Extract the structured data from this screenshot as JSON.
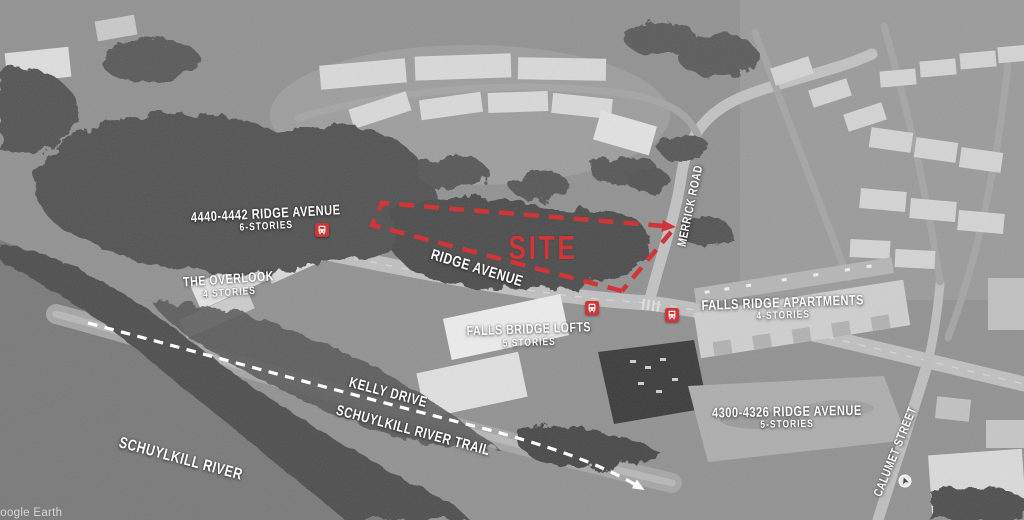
{
  "map": {
    "watermark": "Google Earth",
    "site": {
      "label": "SITE"
    },
    "streets": {
      "ridge_avenue": "RIDGE AVENUE",
      "merrick_road": "MERRICK ROAD",
      "kelly_drive": "KELLY DRIVE",
      "schuylkill_river_trail": "SCHUYLKILL RIVER TRAIL",
      "calumet_street": "CALUMET STREET"
    },
    "water": {
      "schuylkill_river": "SCHUYLKILL RIVER"
    },
    "buildings": {
      "ridge_4440_4442": {
        "name": "4440-4442 RIDGE AVENUE",
        "stories": "6-STORIES"
      },
      "the_overlook": {
        "name": "THE OVERLOOK",
        "stories": "4 STORIES"
      },
      "falls_bridge_lofts": {
        "name": "FALLS BRIDGE LOFTS",
        "stories": "5 STORIES"
      },
      "falls_ridge_apartments": {
        "name": "FALLS RIDGE APARTMENTS",
        "stories": "4-STORIES"
      },
      "ridge_4300_4326": {
        "name": "4300-4326 RIDGE AVENUE",
        "stories": "5-STORIES"
      }
    },
    "icons": {
      "bus_stop_icons": 3
    },
    "colors": {
      "annotation_red": "#d03538",
      "annotation_white": "#ffffff"
    }
  }
}
